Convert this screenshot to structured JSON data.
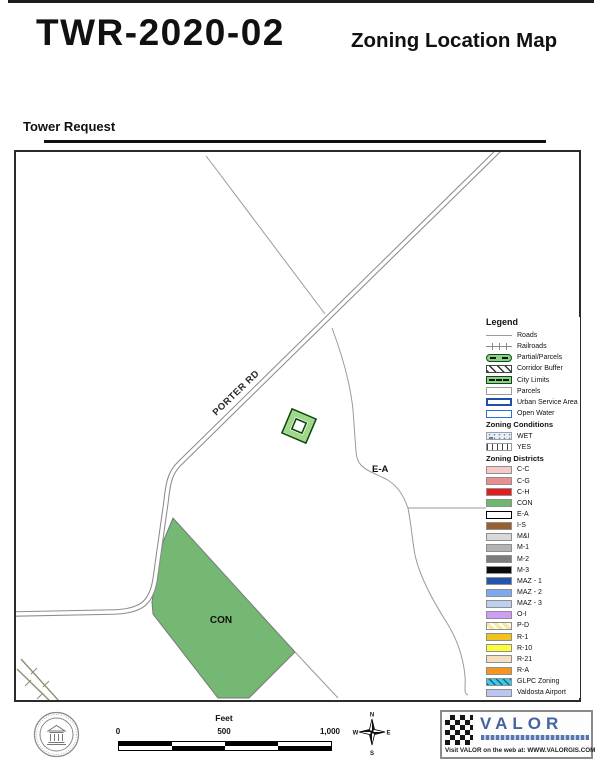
{
  "header": {
    "case_id": "TWR-2020-02",
    "map_title": "Zoning Location Map",
    "subtitle": "Tower Request"
  },
  "map": {
    "road_label": "PORTER RD",
    "ea_label": "E-A",
    "con_label": "CON",
    "con_fill_color": "#74b874",
    "tower_symbol_band_color": "#9fd889",
    "tower_symbol_outline_color": "#0c4a0c"
  },
  "legend": {
    "title": "Legend",
    "base_items": [
      {
        "label": "Roads",
        "swatch": "roads"
      },
      {
        "label": "Railroads",
        "swatch": "railroads"
      },
      {
        "label": "Partial/Parcels",
        "swatch": "partial-parcels"
      },
      {
        "label": "Corridor Buffer",
        "swatch": "corridor-buffer"
      },
      {
        "label": "City Limits",
        "swatch": "city-limits"
      },
      {
        "label": "Parcels",
        "swatch": "parcels"
      },
      {
        "label": "Urban Service Area",
        "swatch": "urban-service-area"
      },
      {
        "label": "Open Water",
        "swatch": "open-water"
      }
    ],
    "conditions_header": "Zoning Conditions",
    "condition_items": [
      {
        "label": "WET",
        "swatch": "wet"
      },
      {
        "label": "YES",
        "swatch": "yes"
      }
    ],
    "districts_header": "Zoning Districts",
    "district_items": [
      {
        "label": "C-C",
        "color": "#f7caca"
      },
      {
        "label": "C-G",
        "color": "#e89090"
      },
      {
        "label": "C-H",
        "color": "#e11d1d"
      },
      {
        "label": "CON",
        "color": "#6fb96f"
      },
      {
        "label": "E-A",
        "color": "#ffffff",
        "border": "#000000"
      },
      {
        "label": "I-S",
        "color": "#9a5f2e"
      },
      {
        "label": "M&I",
        "color": "#d9d9d9"
      },
      {
        "label": "M-1",
        "color": "#b3b3b3"
      },
      {
        "label": "M-2",
        "color": "#7d7d7d"
      },
      {
        "label": "M-3",
        "color": "#0a0a0a"
      },
      {
        "label": "MAZ - 1",
        "color": "#2455ad"
      },
      {
        "label": "MAZ - 2",
        "color": "#7fa8ee"
      },
      {
        "label": "MAZ - 3",
        "color": "#bcd1f2"
      },
      {
        "label": "O-I",
        "color": "#cf9df2"
      },
      {
        "label": "P-D",
        "color": "#f3eaaa",
        "pattern": "diag-light"
      },
      {
        "label": "R-1",
        "color": "#f1c31d"
      },
      {
        "label": "R-10",
        "color": "#fcfc3c"
      },
      {
        "label": "R-21",
        "color": "#f6dfbf"
      },
      {
        "label": "R-A",
        "color": "#f5941f"
      },
      {
        "label": "GLPC Zoning",
        "color": "#41c7e8",
        "pattern": "diag-dark"
      },
      {
        "label": "Valdosta Airport",
        "color": "#bac6ee"
      }
    ]
  },
  "scalebar": {
    "unit": "Feet",
    "ticks": [
      "0",
      "500",
      "1,000"
    ]
  },
  "compass": {
    "n": "N",
    "s": "S",
    "e": "E",
    "w": "W"
  },
  "footer": {
    "valor_word": "VALOR",
    "valor_web": "Visit VALOR on the web at: WWW.VALORGIS.COM"
  }
}
